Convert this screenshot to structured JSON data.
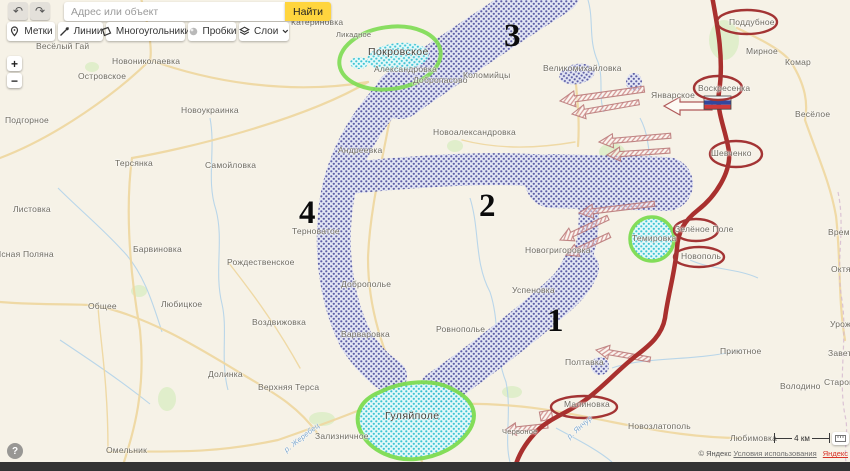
{
  "app": {
    "search": {
      "placeholder": "Адрес или объект",
      "button": "Найти"
    },
    "undo": "↶",
    "redo": "↷",
    "tools": [
      {
        "label": "Метки"
      },
      {
        "label": "Линии"
      },
      {
        "label": "Многоугольники"
      },
      {
        "label": "Пробки"
      },
      {
        "label": "Слои"
      }
    ],
    "zoom_in": "+",
    "zoom_out": "−",
    "help": "?",
    "scale_label": "4 км",
    "attribution": {
      "copyright": "© Яндекс",
      "terms": "Условия использования",
      "brand": "Яндекс"
    }
  },
  "colors": {
    "accent_yellow": "#ffd53e",
    "front_line": "#a9302e",
    "red_ellipse": "#a33434",
    "green_zone": "#7ddc52",
    "blue_area": "#4f51a0",
    "cyan_area": "#2fc4d6",
    "attack_arrow": "#c07878"
  },
  "map": {
    "circled_green": [
      "Покровское",
      "Темировка",
      "Гуляйполе"
    ],
    "circled_red": [
      "Поддубное",
      "Воскресенка",
      "Шевченко",
      "Зелёное Поле",
      "Новополь",
      "Малиновка"
    ],
    "numbers": [
      {
        "label": "3",
        "x": 504,
        "y": 18
      },
      {
        "label": "2",
        "x": 479,
        "y": 188
      },
      {
        "label": "1",
        "x": 547,
        "y": 303
      },
      {
        "label": "4",
        "x": 299,
        "y": 195
      }
    ],
    "places": [
      {
        "name": "Весёлый Гай",
        "x": 36,
        "y": 41
      },
      {
        "name": "Катериновка",
        "x": 291,
        "y": 17
      },
      {
        "name": "Ликадное",
        "x": 336,
        "y": 30,
        "cls": "sm"
      },
      {
        "name": "Новониколаевка",
        "x": 112,
        "y": 56
      },
      {
        "name": "Островское",
        "x": 78,
        "y": 71
      },
      {
        "name": "Покровское",
        "x": 368,
        "y": 46,
        "cls": "town"
      },
      {
        "name": "Александровка",
        "x": 374,
        "y": 64
      },
      {
        "name": "Добропасово",
        "x": 413,
        "y": 75
      },
      {
        "name": "Коломийцы",
        "x": 463,
        "y": 70
      },
      {
        "name": "Великомихайловка",
        "x": 543,
        "y": 63
      },
      {
        "name": "Поддубное",
        "x": 729,
        "y": 17
      },
      {
        "name": "Мирное",
        "x": 746,
        "y": 46
      },
      {
        "name": "Комар",
        "x": 785,
        "y": 57
      },
      {
        "name": "Январское",
        "x": 651,
        "y": 90
      },
      {
        "name": "Воскресенка",
        "x": 698,
        "y": 83
      },
      {
        "name": "Весёлое",
        "x": 795,
        "y": 109
      },
      {
        "name": "Подгорное",
        "x": 5,
        "y": 115
      },
      {
        "name": "Новоукраинка",
        "x": 181,
        "y": 105
      },
      {
        "name": "Новоалександровка",
        "x": 433,
        "y": 127
      },
      {
        "name": "Андреевка",
        "x": 338,
        "y": 145
      },
      {
        "name": "Шевченко",
        "x": 711,
        "y": 148
      },
      {
        "name": "Терсянка",
        "x": 115,
        "y": 158
      },
      {
        "name": "Самойловка",
        "x": 205,
        "y": 160
      },
      {
        "name": "Листовка",
        "x": 13,
        "y": 204
      },
      {
        "name": "Терноватое",
        "x": 292,
        "y": 226
      },
      {
        "name": "Времевка",
        "x": 828,
        "y": 227
      },
      {
        "name": "Зелёное Поле",
        "x": 675,
        "y": 224
      },
      {
        "name": "Новополь",
        "x": 681,
        "y": 251
      },
      {
        "name": "Темировка",
        "x": 632,
        "y": 233
      },
      {
        "name": "Новогригоровка",
        "x": 525,
        "y": 245
      },
      {
        "name": "Ясная Поляна",
        "x": -5,
        "y": 249
      },
      {
        "name": "Барвиновка",
        "x": 133,
        "y": 244
      },
      {
        "name": "Рождественское",
        "x": 227,
        "y": 257
      },
      {
        "name": "Октябрьское",
        "x": 831,
        "y": 264
      },
      {
        "name": "Доброполье",
        "x": 341,
        "y": 279
      },
      {
        "name": "Успеновка",
        "x": 512,
        "y": 285
      },
      {
        "name": "Общее",
        "x": 88,
        "y": 301
      },
      {
        "name": "Любицкое",
        "x": 161,
        "y": 299
      },
      {
        "name": "Воздвижовка",
        "x": 252,
        "y": 317
      },
      {
        "name": "Урожайное",
        "x": 830,
        "y": 319
      },
      {
        "name": "Ровнополье",
        "x": 436,
        "y": 324
      },
      {
        "name": "Варваровка",
        "x": 341,
        "y": 329
      },
      {
        "name": "Приютное",
        "x": 720,
        "y": 346
      },
      {
        "name": "Заветное",
        "x": 828,
        "y": 348
      },
      {
        "name": "Полтавка",
        "x": 565,
        "y": 357
      },
      {
        "name": "Долинка",
        "x": 208,
        "y": 369
      },
      {
        "name": "Верхняя Терса",
        "x": 258,
        "y": 382
      },
      {
        "name": "Володино",
        "x": 780,
        "y": 381
      },
      {
        "name": "Старомлиновка",
        "x": 824,
        "y": 377
      },
      {
        "name": "Малиновка",
        "x": 564,
        "y": 399
      },
      {
        "name": "Гуляйполе",
        "x": 385,
        "y": 410,
        "cls": "town"
      },
      {
        "name": "Новозлатополь",
        "x": 628,
        "y": 421
      },
      {
        "name": "Зализничное",
        "x": 315,
        "y": 431
      },
      {
        "name": "Червоное",
        "x": 502,
        "y": 427,
        "cls": "sm"
      },
      {
        "name": "Любимовка",
        "x": 730,
        "y": 433
      },
      {
        "name": "Омельник",
        "x": 106,
        "y": 445
      },
      {
        "name": "р. Жеребец",
        "x": 285,
        "y": 446,
        "cls": "river",
        "rot": -38
      },
      {
        "name": "р. Янчур",
        "x": 568,
        "y": 433,
        "cls": "river",
        "rot": -42
      }
    ]
  }
}
